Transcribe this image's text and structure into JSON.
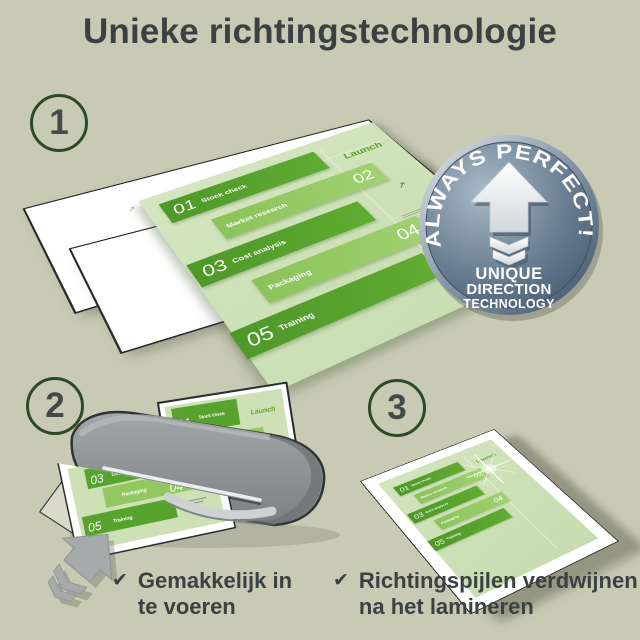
{
  "title": "Unieke richtingstechnologie",
  "steps": {
    "one": "1",
    "two": "2",
    "three": "3"
  },
  "badge": {
    "curved": "ALWAYS PERFECT!",
    "line1": "UNIQUE",
    "line2": "DIRECTION",
    "line3": "TECHNOLOGY"
  },
  "doc": {
    "launch": "Launch",
    "items": [
      {
        "num": "01",
        "label": "Stock check"
      },
      {
        "num": "02",
        "label": "Market research"
      },
      {
        "num": "03",
        "label": "Cost analysis"
      },
      {
        "num": "04",
        "label": "Packaging"
      },
      {
        "num": "05",
        "label": "Training"
      }
    ]
  },
  "checklist": {
    "item1": {
      "mark": "✔",
      "line1": "Gemakkelijk in",
      "line2": "te voeren"
    },
    "item2": {
      "mark": "✔",
      "line1": "Richtingspijlen verdwijnen",
      "line2": "na het lamineren"
    }
  },
  "icons": {
    "direction_mark": "↗"
  },
  "colors": {
    "background": "#c9cab4",
    "title_text": "#3b4143",
    "circle_outline": "#2c4a26",
    "block_dark": "#54a02c",
    "block_light": "#95c965",
    "doc_panel": "#cfe2ba",
    "badge_face": "#5d7389",
    "machine_gray": "#8b9094",
    "arrow_gray": "#a6aaab"
  }
}
